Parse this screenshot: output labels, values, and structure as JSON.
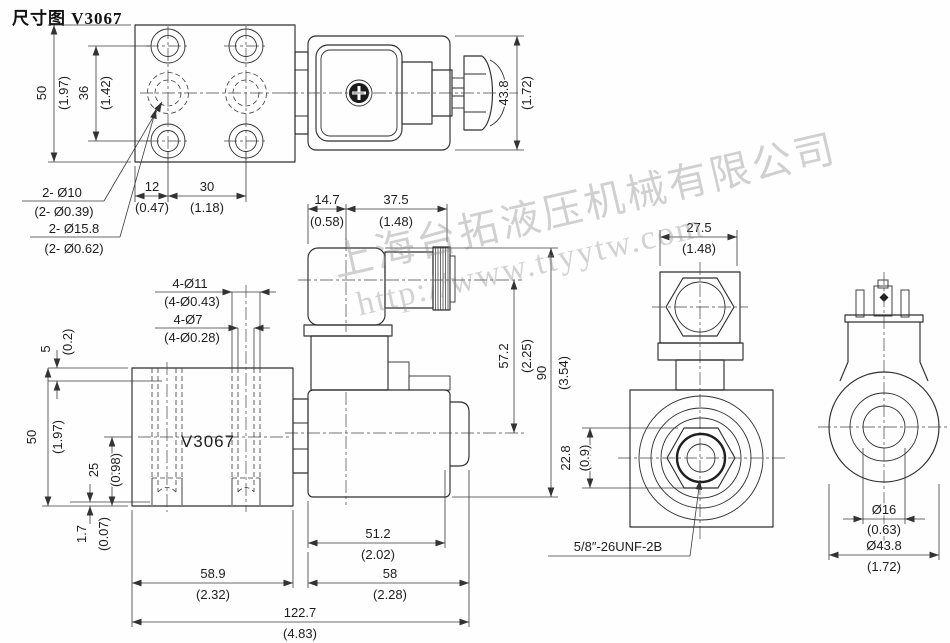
{
  "title": "尺寸图 V3067",
  "watermark": {
    "line1": "上海台拓液压机械有限公司",
    "line2": "http://www.ttyytw.com"
  },
  "block_label": "V3067",
  "colors": {
    "line": "#2e2e2e",
    "watermark_gray": "#8c8c8c",
    "background": "#fefefe"
  },
  "dims": {
    "plate_h_mm": "50",
    "plate_h_in": "(1.97)",
    "plate_span_mm": "36",
    "plate_span_in": "(1.42)",
    "plate_off_mm": "12",
    "plate_off_in": "(0.47)",
    "plate_pitch_mm": "30",
    "plate_pitch_in": "(1.18)",
    "top_h_mm": "43.8",
    "top_h_in": "(1.72)",
    "conn_off_mm": "14.7",
    "conn_off_in": "(0.58)",
    "coil_w_mm": "37.5",
    "coil_w_in": "(1.48)",
    "cl_h_mm": "57.2",
    "cl_h_in": "(2.25)",
    "total_h_mm": "90",
    "total_h_in": "(3.54)",
    "hex_af_mm": "22.8",
    "hex_af_in": "(0.9)",
    "front_w_mm": "27.5",
    "front_w_in": "(1.48)",
    "block_top_mm": "5",
    "block_top_in": "(0.2)",
    "block_h_mm": "50",
    "block_h_in": "(1.97)",
    "block_cl_mm": "25",
    "block_cl_in": "(0.98)",
    "block_lip_mm": "1.7",
    "block_lip_in": "(0.07)",
    "body_l_mm": "51.2",
    "body_l_in": "(2.02)",
    "body_total_mm": "58",
    "body_total_in": "(2.28)",
    "block_w_mm": "58.9",
    "block_w_in": "(2.32)",
    "overall_mm": "122.7",
    "overall_in": "(4.83)",
    "coil_id_mm": "Ø16",
    "coil_id_in": "(0.63)",
    "coil_od_mm": "Ø43.8",
    "coil_od_in": "(1.72)"
  },
  "callouts": {
    "holes10_l1": "2- Ø10",
    "holes10_l2": "(2- Ø0.39)",
    "holes158_l1": "2- Ø15.8",
    "holes158_l2": "(2- Ø0.62)",
    "holes11_l1": "4-Ø11",
    "holes11_l2": "(4-Ø0.43)",
    "holes7_l1": "4-Ø7",
    "holes7_l2": "(4-Ø0.28)",
    "thread": "5/8″-26UNF-2B"
  }
}
